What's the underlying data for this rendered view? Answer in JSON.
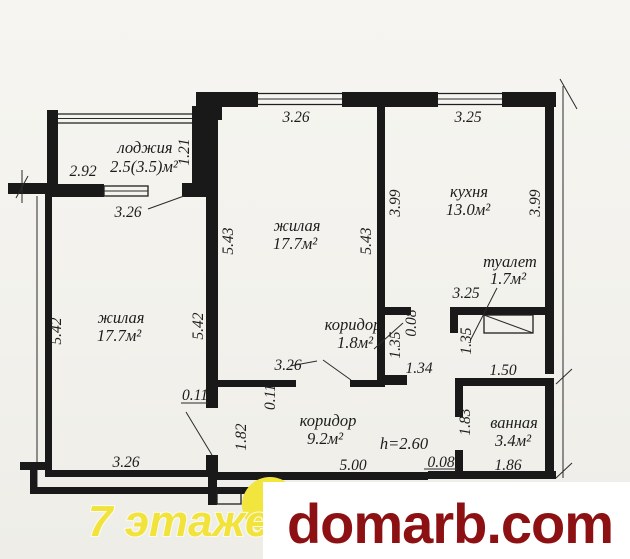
{
  "page": {
    "background": "#f3f2ee",
    "ink": "#1a1a1a"
  },
  "plan": {
    "rooms": {
      "loggia": {
        "label": "лоджия",
        "area": "2.5(3.5)м²"
      },
      "living_left": {
        "label": "жилая",
        "area": "17.7м²"
      },
      "living_center": {
        "label": "жилая",
        "area": "17.7м²"
      },
      "kitchen": {
        "label": "кухня",
        "area": "13.0м²"
      },
      "toilet": {
        "label": "туалет",
        "area": "1.7м²"
      },
      "hall_small": {
        "label": "коридор",
        "area": "1.8м²"
      },
      "hall_main": {
        "label": "коридор",
        "area": "9.2м²"
      },
      "bathroom": {
        "label": "ванная",
        "area": "3.4м²"
      }
    },
    "ceiling_height": "h=2.60",
    "dims": {
      "loggia_outer_width": "2.92",
      "loggia_depth": "1.21",
      "loggia_width": "3.26",
      "living_center_top": "3.26",
      "kitchen_top": "3.25",
      "living_center_left": "5.43",
      "living_center_right": "5.43",
      "kitchen_left": "3.99",
      "kitchen_right": "3.99",
      "living_left_left": "5.42",
      "living_left_right": "5.42",
      "living_left_bottom": "3.26",
      "living_center_bottom": "3.26",
      "toilet_top": "3.25",
      "jamb_kitchen": "0.08",
      "hall_small_height": "1.35",
      "toilet_height": "1.35",
      "hall_small_width": "1.34",
      "toilet_width": "1.50",
      "niche_a": "0.11",
      "niche_b": "0.11",
      "hall_main_left": "1.82",
      "hall_main_bottom": "5.00",
      "jamb_bath": "0.08",
      "bathroom_left": "1.83",
      "bathroom_bottom": "1.86"
    }
  },
  "watermark": {
    "floors": "7 этажей",
    "site": "domarb.com",
    "floors_color": "#f1e33c",
    "site_color": "#8d1013",
    "circle_color": "#f2e53e"
  }
}
